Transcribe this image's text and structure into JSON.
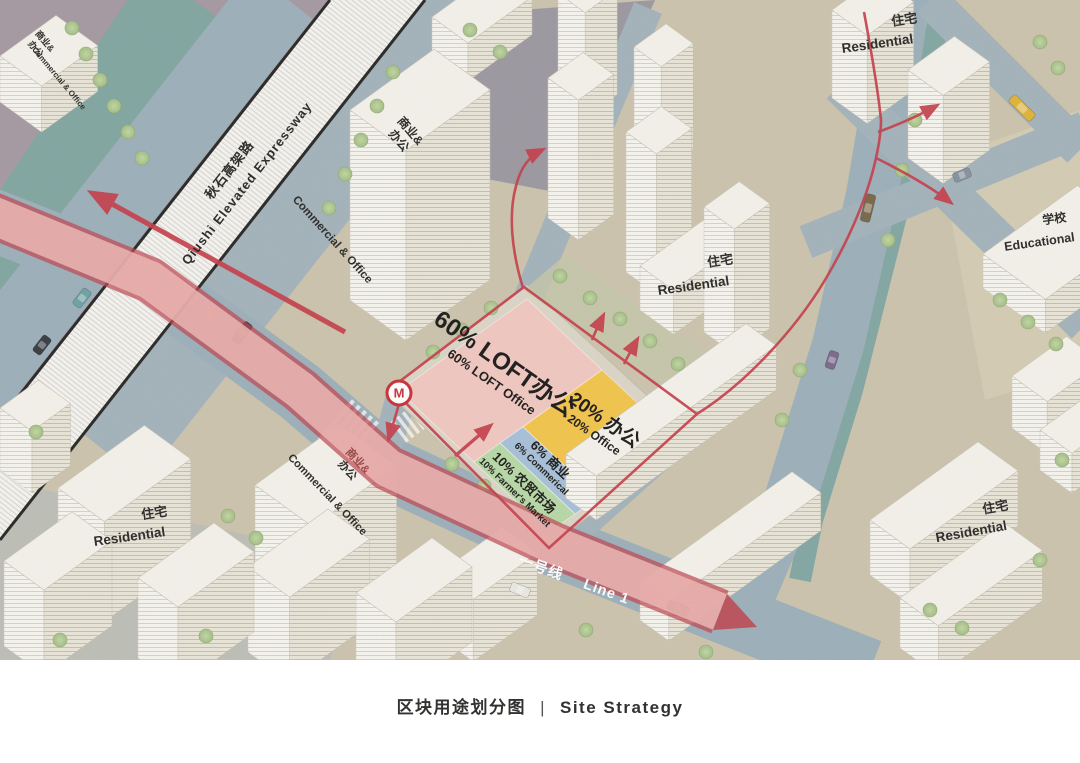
{
  "caption": {
    "zh": "区块用途划分图",
    "divider": "|",
    "en": "Site Strategy"
  },
  "expressway": {
    "zh": "秋石高架路",
    "en": "Qiushi Elevated Expressway"
  },
  "metro_line": {
    "zh": "一号线",
    "en": "Line 1"
  },
  "metro_station": {
    "symbol": "M"
  },
  "zones": [
    {
      "name": "loft-office",
      "zh": "60% LOFT办公",
      "en": "60% LOFT Office",
      "color": "#f2c9c3"
    },
    {
      "name": "office",
      "zh": "20% 办公",
      "en": "20% Office",
      "color": "#f3c64e"
    },
    {
      "name": "commercial",
      "zh": "6% 商业",
      "en": "6% Commerical",
      "color": "#a9c2da"
    },
    {
      "name": "farmers-market",
      "zh": "10% 农贸市场",
      "en": "10% Farmer's Market",
      "color": "#b9daa9"
    }
  ],
  "labels": {
    "commercial_office_zh1": "商业&",
    "commercial_office_zh2": "办公",
    "commercial_office_en": "Commercial & Office",
    "residential_zh": "住宅",
    "residential_en": "Residential",
    "school_zh": "学校",
    "school_en": "Educational"
  },
  "colors": {
    "route_red": "#c7414d",
    "metro_band": "#bf4a54",
    "canal": "#84a8a3",
    "road": "#9eb1bb",
    "paper": "#cdc5ae"
  }
}
